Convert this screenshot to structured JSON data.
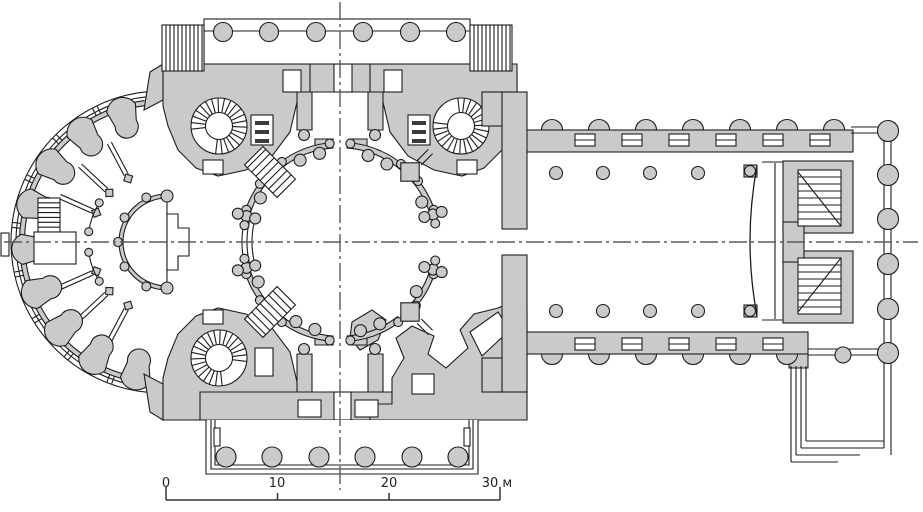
{
  "scale_labels": {
    "t0": "0",
    "t10": "10",
    "t20": "20",
    "t30": "30 м"
  },
  "scale_label_x": [
    166,
    277,
    389,
    497
  ],
  "plan": {
    "w": 923,
    "h": 512,
    "colors": {
      "g": "#c9cbca",
      "ln": "#1d1d1d",
      "ax": "#5a5a5a",
      "wh": "#ffffff",
      "bar": "#333333",
      "dark": "#3a3a3a"
    },
    "ambulatory": {
      "c": [
        162,
        242
      ],
      "outer": [
        {
          "r": 151,
          "a": [
            95,
            265
          ]
        },
        {
          "r": 146,
          "a": [
            96,
            264
          ]
        }
      ],
      "band": {
        "r": 140,
        "w": 5,
        "a": [
          97,
          263
        ]
      },
      "piers": {
        "rp": 120,
        "angles": [
          107,
          126,
          145,
          164,
          183,
          202,
          221,
          240,
          259
        ]
      },
      "connectors": {
        "r1": 142.5,
        "r2": 150.5,
        "off": 2.5,
        "angles": [
          116.5,
          135.5,
          154.5,
          173.5,
          192.5,
          211.5,
          230.5,
          249.5
        ]
      },
      "walls": {
        "r1": 76,
        "r2": 112,
        "off": 2.2,
        "cap_r": 72,
        "cap_s": 5,
        "angles": [
          118,
          137,
          156,
          204,
          223,
          242
        ]
      },
      "innerArcs": {
        "r": 74,
        "cap": 4,
        "spans": [
          [
            148,
            172
          ],
          [
            188,
            212
          ]
        ]
      }
    },
    "west_annex": {
      "tab": [
        1,
        233,
        8,
        23
      ],
      "ladder": [
        38,
        198,
        22,
        34
      ],
      "rungs": 6,
      "square": [
        34,
        232,
        42,
        32
      ]
    },
    "apse": {
      "c": [
        167,
        242
      ],
      "r": 46,
      "w": 4,
      "a": [
        90,
        270
      ],
      "bumps": {
        "r": 49,
        "br": 4.5,
        "angles": [
          115,
          150,
          180,
          210,
          245
        ]
      },
      "caps": [
        [
          167,
          196
        ],
        [
          167,
          288
        ]
      ],
      "cap_r": 6,
      "chord": [
        167,
        196,
        167,
        288
      ],
      "notch": "M167,214 L178,214 L178,228 L189,228 L189,256 L178,256 L178,270 L167,270 Z"
    },
    "central": {
      "masses": [
        "M160,71 L204,71 L204,64 L470,64 L470,71 L517,71 L517,92 L160,92 Z",
        "M163,64 L310,64 L310,92 L298,98 L290,132 L272,156 L246,170 L218,176 L196,168 L178,150 L168,126 L163,106 Z",
        "M517,64 L370,64 L370,92 L382,98 L390,132 L408,156 L434,170 L462,176 L484,168 L502,150 L512,126 L517,106 Z",
        "M163,420 L310,420 L310,392 L298,386 L290,352 L272,328 L246,314 L218,308 L196,316 L178,334 L168,358 L163,378 Z",
        "M200,392 L485,392 L485,420 L200,420 Z",
        "M527,310 L512,302 L498,308 L474,314 L460,330 L468,348 L446,368 L428,354 L434,336 L412,326 L396,338 L404,358 L392,378 L392,404 L370,404 L370,420 L527,420 Z",
        "M352,322 L372,310 L386,320 L378,340 L360,350 L350,338 Z",
        "M297,92 L312,92 L312,130 L297,130 Z",
        "M368,92 L383,92 L383,130 L368,130 Z",
        "M315,139 L333,139 L333,147 L315,147 Z",
        "M349,139 L367,139 L367,147 L349,147 Z",
        "M297,354 L312,354 L312,392 L297,392 Z",
        "M368,354 L383,354 L383,392 L368,392 Z",
        "M315,337 L333,337 L333,345 L315,345 Z",
        "M349,337 L367,337 L367,345 L349,345 Z",
        "M150,72 L163,64 L163,100 L144,110 Z",
        "M150,412 L163,420 L163,384 L144,374 Z",
        "M789,354 L808,354 L808,368 L789,368 Z"
      ],
      "whites": [
        [
          283,
          70,
          18,
          22
        ],
        [
          334,
          64,
          18,
          28
        ],
        [
          384,
          70,
          18,
          22
        ],
        [
          203,
          160,
          20,
          14
        ],
        [
          457,
          160,
          20,
          14
        ],
        [
          203,
          310,
          20,
          14
        ],
        [
          255,
          348,
          18,
          28
        ],
        [
          298,
          400,
          23,
          17
        ],
        [
          355,
          400,
          23,
          17
        ],
        [
          334,
          392,
          17,
          28
        ],
        [
          412,
          374,
          22,
          20
        ]
      ],
      "channel": "M470,332 L498,312 L510,330 L482,356 Z",
      "steps3": [
        [
          251,
          115
        ],
        [
          408,
          115
        ]
      ],
      "spirals": [
        {
          "c": [
            219,
            126
          ],
          "gap": 225
        },
        {
          "c": [
            461,
            126
          ],
          "gap": 135
        },
        {
          "c": [
            219,
            358
          ],
          "gap": 315
        }
      ]
    },
    "rotunda": {
      "c": [
        340,
        242
      ],
      "R": 97,
      "w": 5.5,
      "segments": [
        [
          94,
          128
        ],
        [
          142,
          163
        ],
        [
          197,
          218
        ],
        [
          232,
          266
        ],
        [
          274,
          308
        ],
        [
          318,
          343
        ],
        [
          17,
          40
        ],
        [
          50,
          86
        ]
      ],
      "inner_bump_r": 91,
      "inner_bump_s": 6,
      "cap_r": 99,
      "cap_s": 4.5,
      "screen": {
        "radii": [
          88,
          93,
          98
        ],
        "a": [
          166,
          194
        ]
      },
      "clusters": [
        {
          "a": 164.5,
          "x": 170
        },
        {
          "a": 195.5,
          "x": 190
        },
        {
          "a": 343.5,
          "x": 349
        },
        {
          "a": 16.5,
          "x": 11
        }
      ],
      "blocks": [
        45,
        315
      ],
      "stairs": [
        135,
        225
      ],
      "tip_bumps": [
        [
          304,
          135
        ],
        [
          375,
          135
        ],
        [
          304,
          349
        ],
        [
          375,
          349
        ]
      ]
    },
    "nave": {
      "bump_r": 10.5,
      "top": {
        "band": [
          512,
          130,
          341,
          22
        ],
        "bump_y": 130,
        "bump_x": [
          552,
          599,
          646,
          693,
          740,
          787,
          834
        ],
        "slot_y": 134,
        "slot_x": [
          575,
          622,
          669,
          716,
          763,
          810
        ]
      },
      "bottom": {
        "band": [
          512,
          332,
          296,
          22
        ],
        "bump_y": 354,
        "bump_x": [
          552,
          599,
          646,
          693,
          740,
          787
        ],
        "slot_y": 338,
        "slot_x": [
          575,
          622,
          669,
          716,
          763
        ]
      },
      "walls": [
        [
          502,
          92,
          25,
          137
        ],
        [
          502,
          255,
          25,
          137
        ],
        [
          482,
          92,
          20,
          34
        ],
        [
          482,
          358,
          20,
          34
        ]
      ],
      "cols": {
        "r": 6.5,
        "pts": [
          [
            556,
            173
          ],
          [
            603,
            173
          ],
          [
            650,
            173
          ],
          [
            698,
            173
          ],
          [
            556,
            311
          ],
          [
            603,
            311
          ],
          [
            650,
            311
          ],
          [
            698,
            311
          ]
        ]
      },
      "icono": {
        "bow": "M757,166 Q743,241 757,316",
        "line": [
          775,
          163,
          775,
          319
        ],
        "plates": [
          [
            762,
            162,
            850,
            162
          ],
          [
            762,
            320,
            850,
            320
          ]
        ],
        "brackets": [
          [
            744,
            165,
            13,
            12
          ],
          [
            744,
            305,
            13,
            12
          ]
        ],
        "caps": [
          [
            750,
            171
          ],
          [
            750,
            311
          ]
        ],
        "cap_r": 5.5
      },
      "altar": {
        "gray": [
          [
            783,
            161,
            70,
            72
          ],
          [
            783,
            251,
            70,
            72
          ],
          [
            783,
            222,
            21,
            40
          ]
        ],
        "white": [
          [
            798,
            170,
            43,
            56
          ],
          [
            798,
            258,
            43,
            56
          ]
        ],
        "tread_step": 7,
        "diag": [
          [
            798,
            172,
            841,
            226
          ],
          [
            798,
            312,
            841,
            258
          ]
        ]
      },
      "colonnade": {
        "lines": [
          [
            884,
            131,
            884,
            448
          ],
          [
            891,
            127,
            891,
            455
          ],
          [
            851,
            127,
            891,
            127
          ],
          [
            851,
            133,
            884,
            133
          ],
          [
            808,
            349,
            884,
            349
          ],
          [
            808,
            355,
            891,
            355
          ]
        ],
        "bump": [
          843,
          355,
          8
        ],
        "cols_r": 10.5,
        "cols": [
          [
            888,
            131
          ],
          [
            888,
            175
          ],
          [
            888,
            219
          ],
          [
            888,
            264
          ],
          [
            888,
            309
          ],
          [
            888,
            353
          ]
        ]
      },
      "nested": [
        [
          806,
          366,
          806,
          441
        ],
        [
          806,
          441,
          884,
          441
        ],
        [
          801,
          366,
          801,
          448
        ],
        [
          801,
          448,
          884,
          448
        ],
        [
          796,
          366,
          796,
          455
        ],
        [
          796,
          455,
          860,
          455
        ],
        [
          791,
          366,
          791,
          462
        ],
        [
          791,
          462,
          838,
          462
        ]
      ]
    },
    "portico_n": {
      "floor": [
        204,
        19,
        266,
        45
      ],
      "line_y": 31,
      "col_r": 9.5,
      "col_y": 32,
      "col_x": [
        223,
        269,
        316,
        363,
        410,
        456
      ],
      "hatch": [
        [
          162,
          25,
          42,
          46
        ],
        [
          470,
          25,
          42,
          46
        ]
      ],
      "hatch_step": 4
    },
    "portico_s": {
      "left": 206,
      "right": 478,
      "top": 420,
      "bot": 474,
      "insets": [
        0,
        5,
        9
      ],
      "col_r": 10,
      "col_y": 457,
      "col_x": [
        226,
        272,
        319,
        365,
        412,
        458
      ],
      "slots": [
        [
          214,
          428,
          6,
          18
        ],
        [
          464,
          428,
          6,
          18
        ]
      ]
    },
    "axes": {
      "h": [
        4,
        242,
        918,
        242
      ],
      "v": [
        340,
        2,
        340,
        490
      ],
      "dash": "18 4 3 4"
    },
    "scalebar": {
      "y": 500,
      "x1": 166,
      "x2": 500,
      "ticks_major": [
        166,
        500
      ],
      "ticks_minor": [
        277.5,
        389
      ],
      "major_h": 13,
      "minor_h": 7
    }
  }
}
